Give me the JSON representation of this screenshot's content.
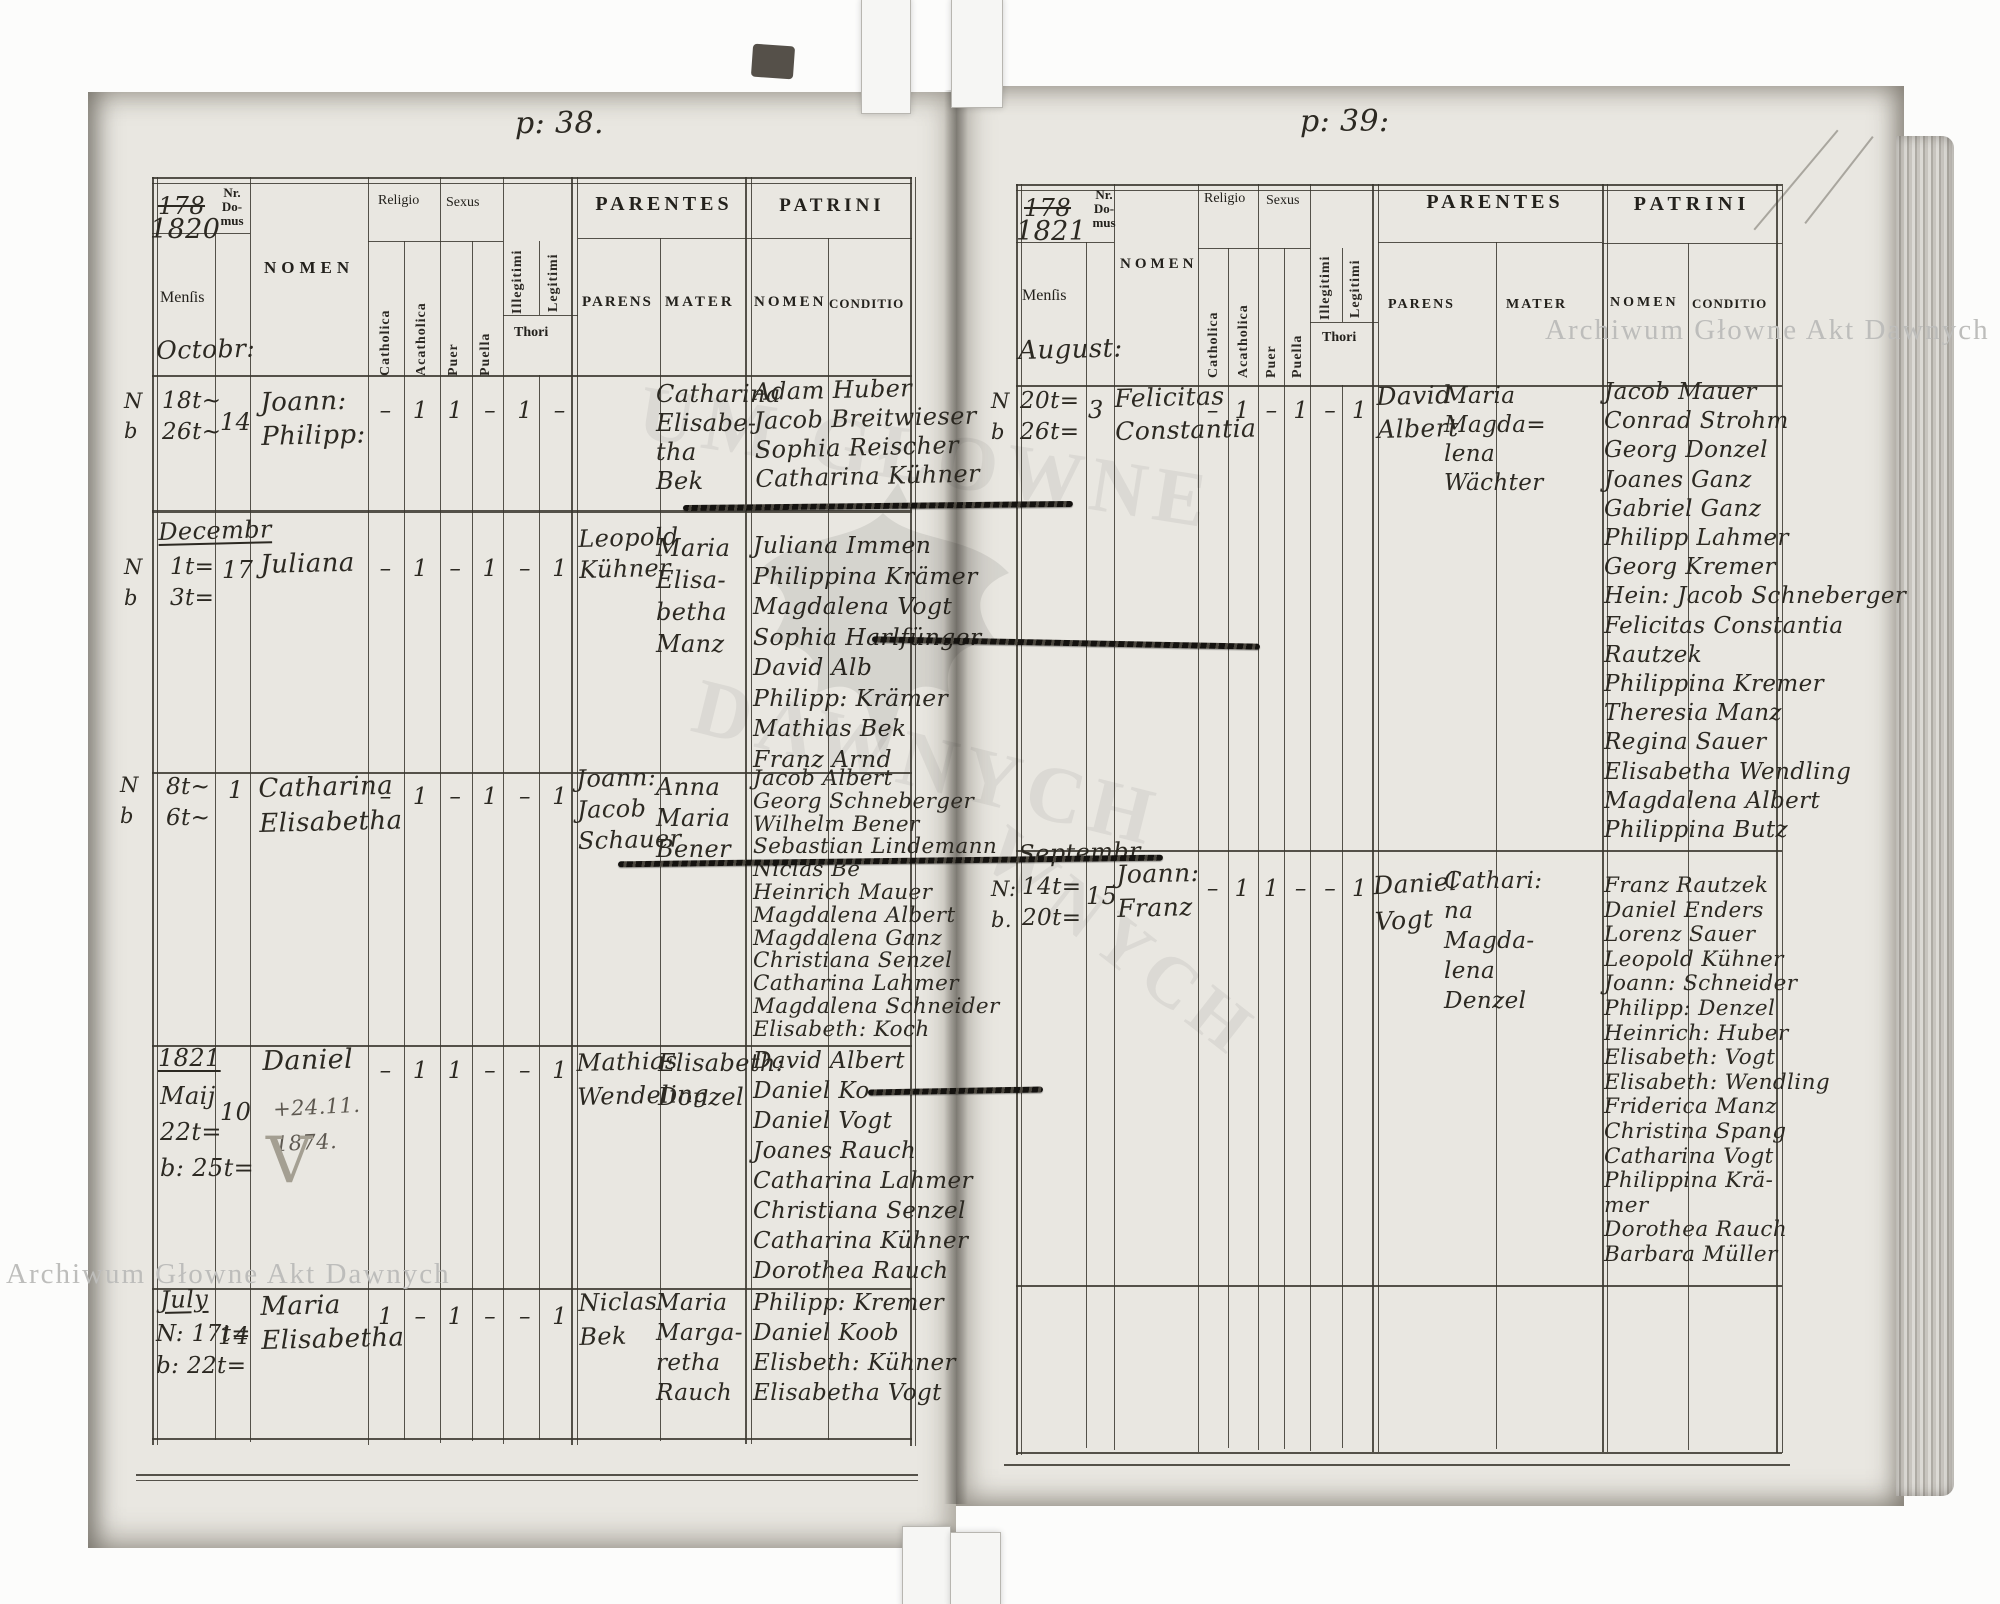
{
  "scan": {
    "watermark_text": "Archiwum Głowne Akt Dawnych",
    "watermark_fragment_top": "UM GŁOWNE",
    "watermark_fragment_bottom": "DAWNYCH",
    "watermark_fragment_right": "WNYCH"
  },
  "headers": {
    "nr_domus": "Nr.\nDo-\nmus",
    "nomen": "NOMEN",
    "mensis": "Menſis",
    "religio": "Religio",
    "sexus": "Sexus",
    "catholica": "Catholica",
    "acatholica": "Acatholica",
    "puer": "Puer",
    "puella": "Puella",
    "illegitimi": "Illegitimi",
    "legitimi": "Legitimi",
    "thori": "Thori",
    "parentes": "PARENTES",
    "patrini": "PATRINI",
    "parens": "PARENS",
    "mater": "MATER",
    "patrini_nomen": "NOMEN",
    "conditio": "CONDITIO"
  },
  "left_page": {
    "page_no": "p: 38.",
    "year_struck": "178",
    "year": "1820",
    "month_under_mensis": "Octobr:",
    "entries": [
      {
        "margin": "N\nb",
        "dates": "18t~\n26t~",
        "house_no": "14",
        "name": "Joann:\nPhilipp:",
        "marks": [
          "–",
          "1",
          "1",
          "–",
          "1",
          "–"
        ],
        "mater": "Catharina\nElisabe-\ntha\nBek",
        "patrini": "Adam Huber\nJacob Breitwieser\nSophia Reischer\nCatharina Kühner"
      },
      {
        "month": "Decembr",
        "margin": "N\nb",
        "dates": "1t=\n3t=",
        "house_no": "17",
        "name": "Juliana",
        "marks": [
          "–",
          "1",
          "–",
          "1",
          "–",
          "1"
        ],
        "parens": "Leopold\nKühner",
        "mater": "Maria\nElisa-\nbetha\nManz",
        "patrini": "Juliana Immen\nPhilippina Krämer\nMagdalena Vogt\nSophia Harlfünger\nDavid Alb\nPhilipp: Krämer\nMathias Bek\nFranz Arnd"
      },
      {
        "margin": "N\nb",
        "dates": "8t~\n6t~",
        "house_no": "1",
        "name": "Catharina\nElisabetha",
        "marks": [
          "–",
          "1",
          "–",
          "1",
          "–",
          "1"
        ],
        "parens": "Joann:\nJacob\nSchauer",
        "mater": "Anna\nMaria\nBener",
        "patrini": "Jacob Albert\nGeorg Schneberger\nWilhelm Bener\nSebastian Lindemann\nNiclas Be\nHeinrich Mauer\nMagdalena Albert\nMagdalena Ganz\nChristiana Senzel\nCatharina Lahmer\nMagdalena Schneider\nElisabeth: Koch"
      },
      {
        "month": "1821",
        "dates": "Maij\n22t=\nb: 25t=",
        "house_no": "10",
        "name": "Daniel",
        "note": "+24.11.\n1874.",
        "pencil_mark": "V",
        "marks": [
          "–",
          "1",
          "1",
          "–",
          "–",
          "1"
        ],
        "parens": "Mathias\nWendeling",
        "mater": "Elisabeth:\nDonzel",
        "patrini": "David Albert\nDaniel Ko\nDaniel Vogt\nJoanes Rauch\nCatharina Lahmer\nChristiana Senzel\nCatharina Kühner\nDorothea Rauch"
      },
      {
        "month": "July",
        "dates": "N: 17t=\nb: 22t=",
        "house_no": "14",
        "name": "Maria\nElisabetha",
        "marks": [
          "1",
          "–",
          "1",
          "–",
          "–",
          "1"
        ],
        "parens": "Niclas\nBek",
        "mater": "Maria\nMarga-\nretha\nRauch",
        "patrini": "Philipp: Kremer\nDaniel Koob\nElisbeth: Kühner\nElisabetha Vogt"
      }
    ]
  },
  "right_page": {
    "page_no": "p: 39:",
    "year_struck": "178",
    "year": "1821",
    "month_under_mensis": "August:",
    "entries": [
      {
        "margin": "N\nb",
        "dates": "20t=\n26t=",
        "house_no": "3",
        "name": "Felicitas\nConstantia",
        "marks": [
          "–",
          "1",
          "–",
          "1",
          "–",
          "1"
        ],
        "parens": "David\nAlbert",
        "mater": "Maria\nMagda=\nlena\nWächter",
        "patrini": "Jacob Mauer\nConrad Strohm\nGeorg Donzel\nJoanes Ganz\nGabriel Ganz\nPhilipp Lahmer\nGeorg Kremer\nHein: Jacob Schneberger\nFelicitas Constantia\nRautzek\nPhilippina Kremer\nTheresia Manz\nRegina Sauer\nElisabetha Wendling\nMagdalena Albert\nPhilippina Butz"
      },
      {
        "month": "Septembr",
        "margin": "N:\nb.",
        "dates": "14t=\n20t=",
        "house_no": "15",
        "name": "Joann:\nFranz",
        "marks": [
          "–",
          "1",
          "1",
          "–",
          "–",
          "1"
        ],
        "parens": "Daniel\nVogt",
        "mater": "Cathari:\nna\nMagda-\nlena\nDenzel",
        "patrini": "Franz Rautzek\nDaniel Enders\nLorenz Sauer\nLeopold Kühner\nJoann: Schneider\nPhilipp: Denzel\nHeinrich: Huber\nElisabeth: Vogt\nElisabeth: Wendling\nFriderica Manz\nChristina Spang\nCatharina Vogt\nPhilippina Krä-\nmer\nDorothea Rauch\nBarbara Müller"
      }
    ]
  }
}
